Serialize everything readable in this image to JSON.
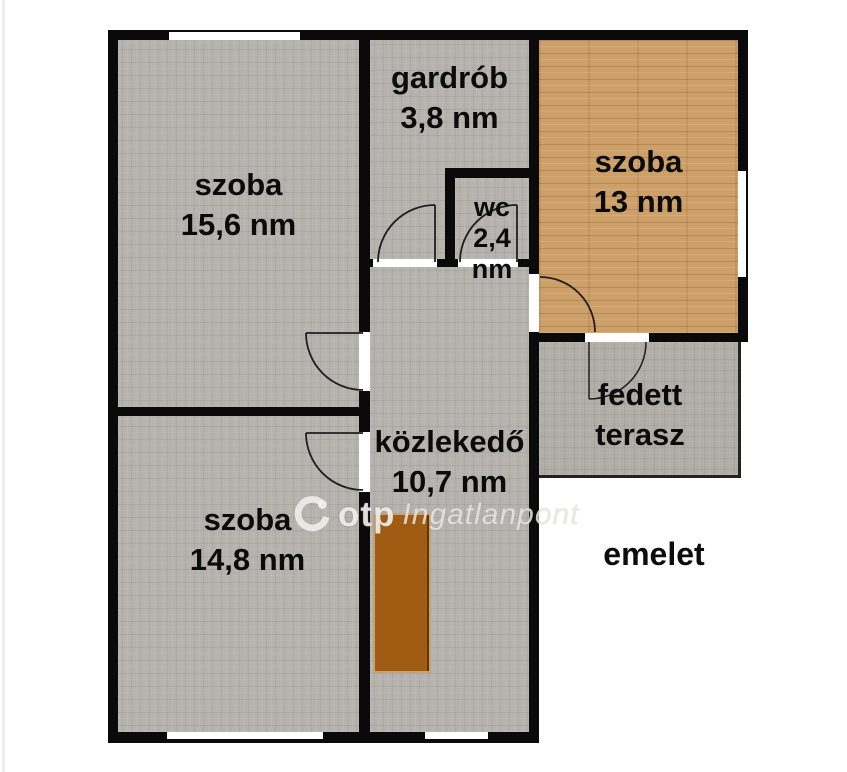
{
  "floor_label": "emelet",
  "watermark": {
    "logo_icon": "otp-circle-logo",
    "brand": "otp",
    "name": "Ingatlanpont"
  },
  "rooms": {
    "szoba15": {
      "line1": "szoba",
      "line2": "15,6 nm"
    },
    "szoba14": {
      "line1": "szoba",
      "line2": "14,8 nm"
    },
    "szoba13": {
      "line1": "szoba",
      "line2": "13 nm"
    },
    "gardrob": {
      "line1": "gardrób",
      "line2": "3,8 nm"
    },
    "wc": {
      "line1": "wc",
      "line2": "2,4 nm"
    },
    "kozlekedo": {
      "line1": "közlekedő",
      "line2": "10,7 nm"
    },
    "terasz": {
      "line1": "fedett",
      "line2": "terasz"
    }
  },
  "colors": {
    "wall": "#0a0a0a",
    "room_gray": "#b6b3ae",
    "terrace_gray": "#b1aea8",
    "wood": "#cd9f69",
    "stairs_brown": "#a05c12",
    "background": "#ffffff"
  }
}
